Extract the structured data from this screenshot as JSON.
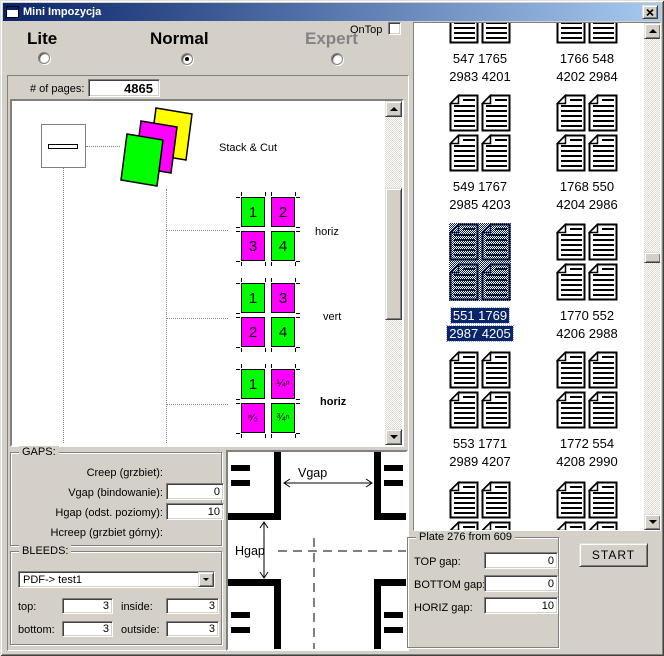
{
  "window": {
    "title": "Mini Impozycja"
  },
  "modes": [
    {
      "label": "Lite",
      "selected": false,
      "disabled": false
    },
    {
      "label": "Normal",
      "selected": true,
      "disabled": false
    },
    {
      "label": "Expert",
      "selected": false,
      "disabled": true
    }
  ],
  "ontop": {
    "label": "OnTop",
    "checked": false
  },
  "pages": {
    "label": "# of pages:",
    "value": "4865"
  },
  "tree": {
    "stack_label": "Stack & Cut",
    "groups": [
      {
        "label": "horiz",
        "bold": false,
        "cells": [
          {
            "t": "1",
            "c": "#00FF00"
          },
          {
            "t": "2",
            "c": "#FF00FF"
          },
          {
            "t": "3",
            "c": "#FF00FF"
          },
          {
            "t": "4",
            "c": "#00FF00"
          }
        ]
      },
      {
        "label": "vert",
        "bold": false,
        "cells": [
          {
            "t": "1",
            "c": "#00FF00"
          },
          {
            "t": "3",
            "c": "#FF00FF"
          },
          {
            "t": "2",
            "c": "#FF00FF"
          },
          {
            "t": "4",
            "c": "#00FF00"
          }
        ]
      },
      {
        "label": "horiz",
        "bold": true,
        "cells": [
          {
            "t": "1",
            "c": "#00FF00"
          },
          {
            "t": "¼ⁿ",
            "c": "#FF00FF"
          },
          {
            "t": "ⁿ⁄₂",
            "c": "#FF00FF"
          },
          {
            "t": "¾ⁿ",
            "c": "#00FF00"
          }
        ]
      }
    ]
  },
  "gaps": {
    "title": "GAPS:",
    "rows": [
      {
        "label": "Creep (grzbiet):"
      },
      {
        "label": "Vgap (bindowanie):",
        "value": "0"
      },
      {
        "label": "Hgap (odst. poziomy):",
        "value": "10"
      },
      {
        "label": "Hcreep (grzbiet górny):"
      }
    ]
  },
  "bleeds": {
    "title": "BLEEDS:",
    "dropdown": "PDF-> test1",
    "fields": [
      {
        "label": "top:",
        "value": "3"
      },
      {
        "label": "inside:",
        "value": "3"
      },
      {
        "label": "bottom:",
        "value": "3"
      },
      {
        "label": "outside:",
        "value": "3"
      }
    ]
  },
  "diagram": {
    "vgap_label": "Vgap",
    "hgap_label": "Hgap"
  },
  "plates": {
    "items": [
      {
        "line1": "547 1765",
        "line2": "2983 4201"
      },
      {
        "line1": "1766 548",
        "line2": "4202 2984"
      },
      {
        "line1": "549 1767",
        "line2": "2985 4203"
      },
      {
        "line1": "1768 550",
        "line2": "4204 2986"
      },
      {
        "line1": "551 1769",
        "line2": "2987 4205",
        "selected": true
      },
      {
        "line1": "1770 552",
        "line2": "4206 2988"
      },
      {
        "line1": "553 1771",
        "line2": "2989 4207"
      },
      {
        "line1": "1772 554",
        "line2": "4208 2990"
      },
      {},
      {}
    ]
  },
  "plate_panel": {
    "title": "Plate 276 from 609",
    "fields": [
      {
        "label": "TOP gap:",
        "value": "0"
      },
      {
        "label": "BOTTOM gap:",
        "value": "0"
      },
      {
        "label": "HORIZ gap:",
        "value": "10"
      }
    ],
    "start_label": "START"
  },
  "colors": {
    "selection": "#0A246A",
    "green": "#00FF00",
    "magenta": "#FF00FF",
    "yellow": "#FFFF00"
  }
}
